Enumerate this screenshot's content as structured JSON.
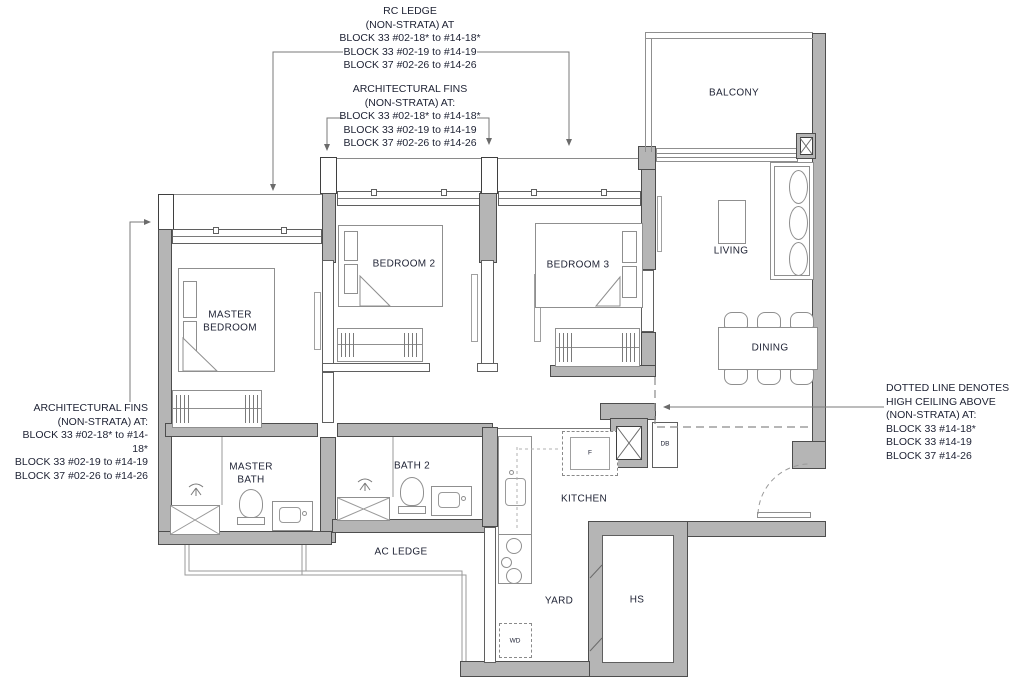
{
  "title": "3-Bedroom Unit Floor Plan",
  "colors": {
    "wall_fill": "#b5b5b5",
    "wall_line": "#4d4d4d",
    "thin_line": "#8a8a8a",
    "text": "#1d2133"
  },
  "annotations": {
    "rc_ledge": {
      "lines": [
        "RC LEDGE",
        "(NON-STRATA) AT",
        "BLOCK 33 #02-18* to #14-18*",
        "BLOCK 33 #02-19  to #14-19",
        "BLOCK 37 #02-26  to #14-26"
      ]
    },
    "arch_fins_top": {
      "lines": [
        "ARCHITECTURAL FINS",
        "(NON-STRATA) AT:",
        "BLOCK 33 #02-18* to #14-18*",
        "BLOCK 33 #02-19  to #14-19",
        "BLOCK 37 #02-26  to #14-26"
      ]
    },
    "arch_fins_left": {
      "lines": [
        "ARCHITECTURAL FINS",
        "(NON-STRATA) AT:",
        "BLOCK 33 #02-18* to #14-18*",
        "BLOCK 33 #02-19  to #14-19",
        "BLOCK 37 #02-26  to #14-26"
      ]
    },
    "high_ceiling": {
      "lines": [
        "DOTTED LINE DENOTES",
        "HIGH CEILING ABOVE",
        "(NON-STRATA) AT:",
        "BLOCK 33 #14-18*",
        "BLOCK 33 #14-19",
        "BLOCK 37 #14-26"
      ]
    }
  },
  "rooms": {
    "balcony": "BALCONY",
    "living": "LIVING",
    "dining": "DINING",
    "bedroom2": "BEDROOM 2",
    "bedroom3": "BEDROOM 3",
    "master_bedroom_l1": "MASTER",
    "master_bedroom_l2": "BEDROOM",
    "master_bath_l1": "MASTER",
    "master_bath_l2": "BATH",
    "bath2": "BATH 2",
    "kitchen": "KITCHEN",
    "ac_ledge": "AC LEDGE",
    "yard": "YARD",
    "hs": "HS"
  },
  "appliances": {
    "fridge": "F",
    "washer_dryer": "WD",
    "db": "DB"
  }
}
